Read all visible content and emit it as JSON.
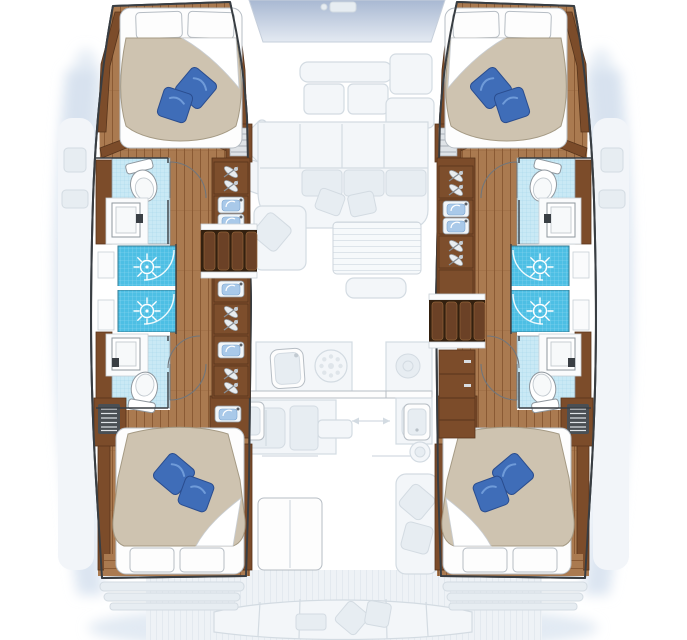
{
  "plan": {
    "kind": "catamaran-deck-plan",
    "hulls": [
      {
        "id": "port-hull",
        "rooms": [
          "fore-cabin",
          "fore-bathroom",
          "shower-stall",
          "shower-stall",
          "aft-bathroom",
          "aft-cabin"
        ]
      },
      {
        "id": "starboard-hull",
        "rooms": [
          "fore-cabin",
          "fore-bathroom",
          "shower-stall",
          "shower-stall",
          "aft-bathroom",
          "aft-cabin"
        ]
      }
    ],
    "center": [
      "fore-lounge",
      "saloon-sofa",
      "nav-seat",
      "saloon-table",
      "galley-sink",
      "stove-burners",
      "cockpit-table",
      "aft-bench"
    ]
  },
  "icons": [
    "double-bed-icon",
    "white-pillow-icon",
    "blue-pillow-icon",
    "toilet-icon",
    "washbasin-icon",
    "vanity-faucet-icon",
    "shower-drain-icon",
    "companionway-steps-icon",
    "louvered-locker-icon",
    "drawer-chest-icon",
    "door-swing-icon",
    "stove-burner-icon",
    "winch-icon"
  ],
  "colors": {
    "hull_outline": "#383d42",
    "wood_floor": "#aa7a50",
    "wood_floor_line": "#8a5a34",
    "wood_trim": "#7c4c2a",
    "wood_trim_dark": "#58351c",
    "step_base": "#33200f",
    "step_tread": "#6b4126",
    "step_tread_edge": "#8f6138",
    "shower_tile": "#4dbfe4",
    "shower_tile_grid": "#8ed8f0",
    "bath_tile": "#c9e9f5",
    "bath_tile_grid": "#a3d5e9",
    "duvet": "#cec3b0",
    "duvet_line": "#a59a84",
    "pillow_white": "#ffffff",
    "pillow_outline": "#b6bdc4",
    "pillow_blue": "#3f6db8",
    "pillow_blue_hi": "#6f9bd9",
    "pillow_blue_dark": "#2a4d8f",
    "fixture_outline": "#8f979e",
    "faded_fill": "#f3f6f9",
    "faded_stroke": "#d3dbe2",
    "faded_dark": "#e7edf2",
    "deck": "#eef2f6",
    "deck_line": "#e3e9ef",
    "window_top": "#a8b8d2",
    "window_bottom": "#e4eaf2",
    "shadow": "#d5e1ee",
    "counter": "#fafbfc"
  }
}
